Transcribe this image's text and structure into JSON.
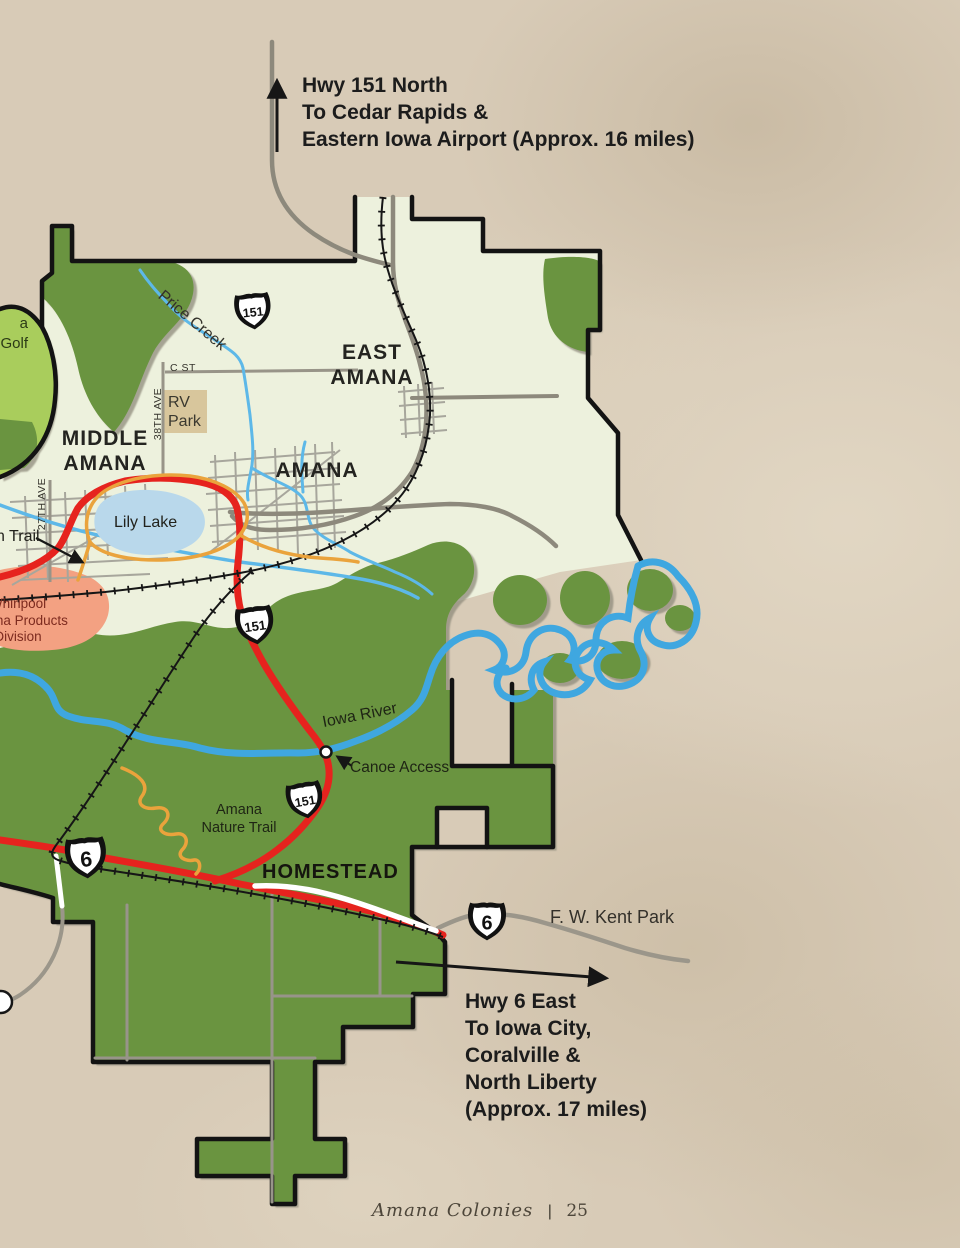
{
  "notes": {
    "north": {
      "lines": [
        "Hwy 151 North",
        "To Cedar Rapids &",
        "Eastern Iowa Airport (Approx. 16 miles)"
      ]
    },
    "south": {
      "lines": [
        "Hwy 6 East",
        "To Iowa City,",
        "Coralville &",
        "North Liberty",
        "(Approx. 17 miles)"
      ]
    }
  },
  "villages": {
    "east_amana": [
      "EAST",
      "AMANA"
    ],
    "middle_amana": [
      "MIDDLE",
      "AMANA"
    ],
    "amana": "AMANA",
    "homestead": "HOMESTEAD"
  },
  "water": {
    "lily_lake": "Lily Lake",
    "price_creek": "Price Creek",
    "iowa_river": "Iowa River"
  },
  "poi": {
    "canoe_access": "Canoe Access",
    "rv_park": [
      "RV",
      "Park"
    ],
    "nature_trail": [
      "Amana",
      "Nature Trail"
    ],
    "kent_park": "F. W. Kent Park",
    "whirlpool": [
      "Whirlpool",
      "Amana Products",
      "Division"
    ],
    "trail_cut": "n Trail",
    "golf_cut": [
      "a",
      "Golf"
    ]
  },
  "streets": {
    "c_st": "C ST",
    "ave_38": "38TH AVE",
    "ave_27": "27TH AVE"
  },
  "shields": {
    "us151": "151",
    "us6": "6"
  },
  "footer": {
    "brand": "Amana Colonies",
    "divider": "|",
    "page": "25"
  },
  "colors": {
    "paper": "#d8cbb7",
    "map_cream": "#edf1dd",
    "forest_green": "#6b9441",
    "golf_green": "#a9cd5c",
    "lake_blue": "#b9d8eb",
    "river_blue": "#3fa7e0",
    "highway_red": "#e6231e",
    "road_gray": "#918d81",
    "trail_orange": "#eaa33c",
    "railroad_black": "#161616",
    "border_black": "#131313",
    "whirlpool_area": "#f3a182",
    "rv_park_area": "#d8c69c"
  }
}
